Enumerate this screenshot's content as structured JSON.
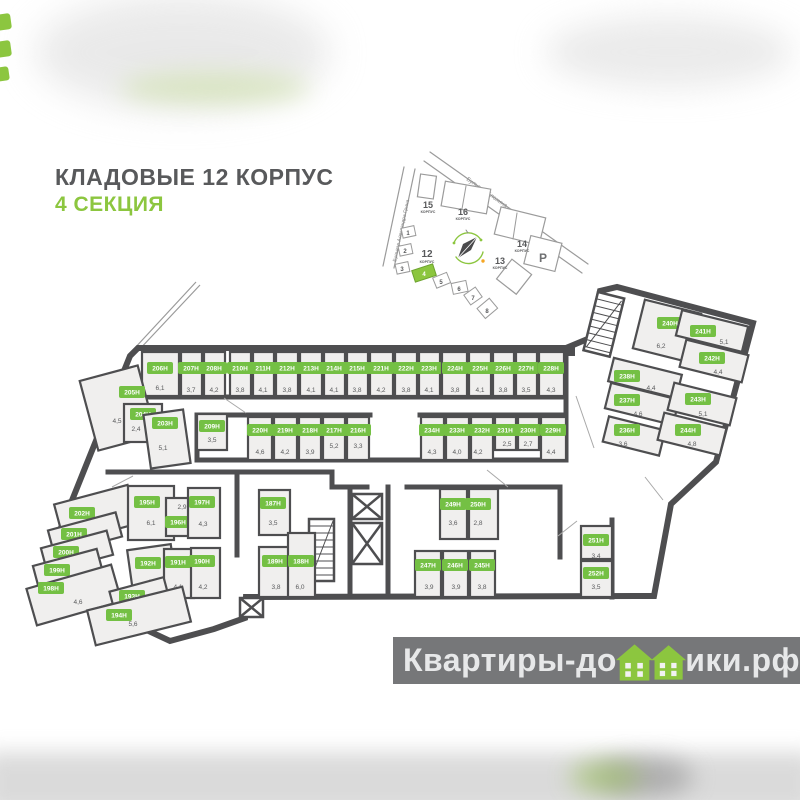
{
  "title": {
    "line1": "КЛАДОВЫЕ 12 КОРПУС",
    "line2": "4 СЕКЦИЯ"
  },
  "colors": {
    "accent_green": "#8cc63f",
    "chip_green": "#74c044",
    "wall": "#4e4e50",
    "room_fill": "#f0efee",
    "text_gray": "#58595b",
    "watermark_bar": "#6c6d6f"
  },
  "watermark": {
    "before": "Квартиры-до",
    "after": "ики.рф"
  },
  "sitemap": {
    "streets": [
      "Бульвар Блохина",
      "Бульвар Александра Грина"
    ],
    "korpus_label": "КОРПУС",
    "buildings": [
      {
        "num": "15"
      },
      {
        "num": "16"
      },
      {
        "num": "14"
      },
      {
        "num": "13"
      },
      {
        "num": "12"
      }
    ],
    "parking": "Р",
    "sections": [
      "1",
      "2",
      "3",
      "4",
      "5",
      "6",
      "7",
      "8"
    ],
    "active_section": "4"
  },
  "legend": {
    "unit_suffix": "Н"
  },
  "rooms": [
    {
      "l": "206Н",
      "a": "6,1",
      "r": [
        142,
        352,
        37,
        44,
        0
      ],
      "c": [
        160,
        368
      ],
      "t": [
        160,
        388
      ]
    },
    {
      "l": "207Н",
      "a": "3,7",
      "r": [
        181,
        352,
        21,
        44,
        0
      ],
      "c": [
        191,
        368
      ],
      "t": [
        191,
        390
      ]
    },
    {
      "l": "208Н",
      "a": "4,2",
      "r": [
        204,
        352,
        21,
        44,
        0
      ],
      "c": [
        214,
        368
      ],
      "t": [
        214,
        390
      ]
    },
    {
      "l": "210Н",
      "a": "3,8",
      "r": [
        230,
        352,
        21,
        44,
        0
      ],
      "c": [
        240,
        368
      ],
      "t": [
        240,
        390
      ]
    },
    {
      "l": "211Н",
      "a": "4,1",
      "r": [
        253,
        352,
        21,
        44,
        0
      ],
      "c": [
        263,
        368
      ],
      "t": [
        263,
        390
      ]
    },
    {
      "l": "212Н",
      "a": "3,8",
      "r": [
        276,
        352,
        22,
        44,
        0
      ],
      "c": [
        287,
        368
      ],
      "t": [
        287,
        390
      ]
    },
    {
      "l": "213Н",
      "a": "4,1",
      "r": [
        300,
        352,
        22,
        44,
        0
      ],
      "c": [
        311,
        368
      ],
      "t": [
        311,
        390
      ]
    },
    {
      "l": "214Н",
      "a": "4,1",
      "r": [
        324,
        352,
        21,
        44,
        0
      ],
      "c": [
        334,
        368
      ],
      "t": [
        334,
        390
      ]
    },
    {
      "l": "215Н",
      "a": "3,8",
      "r": [
        347,
        352,
        21,
        44,
        0
      ],
      "c": [
        357,
        368
      ],
      "t": [
        357,
        390
      ]
    },
    {
      "l": "221Н",
      "a": "4,2",
      "r": [
        370,
        352,
        23,
        44,
        0
      ],
      "c": [
        381,
        368
      ],
      "t": [
        381,
        390
      ]
    },
    {
      "l": "222Н",
      "a": "3,8",
      "r": [
        395,
        352,
        22,
        44,
        0
      ],
      "c": [
        406,
        368
      ],
      "t": [
        406,
        390
      ]
    },
    {
      "l": "223Н",
      "a": "4,1",
      "r": [
        419,
        352,
        21,
        44,
        0
      ],
      "c": [
        429,
        368
      ],
      "t": [
        429,
        390
      ]
    },
    {
      "l": "224Н",
      "a": "3,8",
      "r": [
        442,
        352,
        25,
        44,
        0
      ],
      "c": [
        455,
        368
      ],
      "t": [
        455,
        390
      ]
    },
    {
      "l": "225Н",
      "a": "4,1",
      "r": [
        469,
        352,
        22,
        44,
        0
      ],
      "c": [
        480,
        368
      ],
      "t": [
        480,
        390
      ]
    },
    {
      "l": "226Н",
      "a": "3,8",
      "r": [
        493,
        352,
        21,
        44,
        0
      ],
      "c": [
        503,
        368
      ],
      "t": [
        503,
        390
      ]
    },
    {
      "l": "227Н",
      "a": "3,5",
      "r": [
        516,
        352,
        21,
        44,
        0
      ],
      "c": [
        526,
        368
      ],
      "t": [
        526,
        390
      ]
    },
    {
      "l": "228Н",
      "a": "4,3",
      "r": [
        539,
        352,
        25,
        44,
        0
      ],
      "c": [
        551,
        368
      ],
      "t": [
        551,
        390
      ]
    },
    {
      "l": "209Н",
      "a": "3,5",
      "r": [
        197,
        414,
        30,
        36,
        0
      ],
      "c": [
        212,
        426
      ],
      "t": [
        212,
        440
      ]
    },
    {
      "l": "220Н",
      "a": "4,6",
      "r": [
        248,
        417,
        24,
        43,
        0
      ],
      "c": [
        260,
        430
      ],
      "t": [
        260,
        452
      ]
    },
    {
      "l": "219Н",
      "a": "4,2",
      "r": [
        274,
        417,
        23,
        43,
        0
      ],
      "c": [
        285,
        430
      ],
      "t": [
        285,
        452
      ]
    },
    {
      "l": "218Н",
      "a": "3,9",
      "r": [
        299,
        417,
        22,
        43,
        0
      ],
      "c": [
        310,
        430
      ],
      "t": [
        310,
        452
      ]
    },
    {
      "l": "217Н",
      "a": "5,2",
      "r": [
        323,
        417,
        22,
        43,
        0
      ],
      "c": [
        334,
        430
      ],
      "t": [
        334,
        446
      ]
    },
    {
      "l": "216Н",
      "a": "3,3",
      "r": [
        347,
        417,
        22,
        43,
        0
      ],
      "c": [
        358,
        430
      ],
      "t": [
        358,
        446
      ]
    },
    {
      "l": "234Н",
      "a": "4,3",
      "r": [
        421,
        417,
        23,
        43,
        0
      ],
      "c": [
        432,
        430
      ],
      "t": [
        432,
        452
      ]
    },
    {
      "l": "233Н",
      "a": "4,0",
      "r": [
        446,
        417,
        23,
        43,
        0
      ],
      "c": [
        457,
        430
      ],
      "t": [
        457,
        452
      ]
    },
    {
      "l": "232Н",
      "a": "4,2",
      "r": [
        471,
        417,
        22,
        43,
        0
      ],
      "c": [
        482,
        430
      ],
      "t": [
        478,
        452
      ]
    },
    {
      "l": "231Н",
      "a": "2,5",
      "r": [
        495,
        417,
        21,
        33,
        0
      ],
      "c": [
        505,
        430
      ],
      "t": [
        507,
        444
      ]
    },
    {
      "l": "230Н",
      "a": "2,7",
      "r": [
        518,
        417,
        21,
        33,
        0
      ],
      "c": [
        528,
        430
      ],
      "t": [
        528,
        444
      ]
    },
    {
      "l": "229Н",
      "a": "4,4",
      "r": [
        541,
        417,
        25,
        43,
        0
      ],
      "c": [
        553,
        430
      ],
      "t": [
        551,
        452
      ]
    },
    {
      "l": "205Н",
      "a": "4,5",
      "r": [
        88,
        372,
        60,
        72,
        -15
      ],
      "c": [
        132,
        392
      ],
      "t": [
        117,
        421
      ]
    },
    {
      "l": "204Н",
      "a": "2,4",
      "r": [
        124,
        404,
        38,
        38,
        0
      ],
      "c": [
        143,
        414
      ],
      "t": [
        136,
        429
      ]
    },
    {
      "l": "203Н",
      "a": "5,1",
      "r": [
        147,
        412,
        40,
        54,
        -8
      ],
      "c": [
        165,
        423
      ],
      "t": [
        163,
        448
      ]
    },
    {
      "l": "202Н",
      "a": "5,7",
      "r": [
        58,
        494,
        76,
        40,
        -15
      ],
      "c": [
        82,
        513
      ],
      "t": [
        96,
        520
      ]
    },
    {
      "l": "201Н",
      "a": "3,2",
      "r": [
        50,
        521,
        70,
        25,
        -15
      ],
      "c": [
        74,
        534
      ],
      "t": [
        87,
        541
      ]
    },
    {
      "l": "200Н",
      "a": "2,8",
      "r": [
        43,
        539,
        68,
        25,
        -15
      ],
      "c": [
        66,
        552
      ],
      "t": [
        78,
        559
      ]
    },
    {
      "l": "199Н",
      "a": "2,9",
      "r": [
        35,
        557,
        66,
        25,
        -15
      ],
      "c": [
        57,
        570
      ],
      "t": [
        72,
        578
      ]
    },
    {
      "l": "198Н",
      "a": "4,6",
      "r": [
        30,
        576,
        88,
        38,
        -16
      ],
      "c": [
        51,
        588
      ],
      "t": [
        78,
        602
      ]
    },
    {
      "l": "195Н",
      "a": "6,1",
      "r": [
        128,
        486,
        46,
        54,
        0
      ],
      "c": [
        147,
        502
      ],
      "t": [
        151,
        523
      ]
    },
    {
      "l": "196Н",
      "a": "2,9",
      "r": [
        166,
        498,
        29,
        38,
        0
      ],
      "c": [
        178,
        522
      ],
      "t": [
        182,
        507
      ]
    },
    {
      "l": "197Н",
      "a": "4,3",
      "r": [
        188,
        488,
        32,
        50,
        0
      ],
      "c": [
        202,
        502
      ],
      "t": [
        203,
        524
      ]
    },
    {
      "l": "192Н",
      "a": "4,5",
      "r": [
        130,
        547,
        44,
        44,
        -8
      ],
      "c": [
        148,
        563
      ],
      "t": [
        152,
        582
      ]
    },
    {
      "l": "191Н",
      "a": "4,1",
      "r": [
        164,
        549,
        30,
        49,
        0
      ],
      "c": [
        178,
        562
      ],
      "t": [
        178,
        587
      ]
    },
    {
      "l": "190Н",
      "a": "4,2",
      "r": [
        191,
        548,
        29,
        50,
        0
      ],
      "c": [
        202,
        561
      ],
      "t": [
        203,
        587
      ]
    },
    {
      "l": "193Н",
      "a": "3,4",
      "r": [
        112,
        584,
        56,
        27,
        -15
      ],
      "c": [
        132,
        596
      ],
      "t": [
        146,
        603
      ]
    },
    {
      "l": "194Н",
      "a": "5,6",
      "r": [
        90,
        598,
        98,
        36,
        -14
      ],
      "c": [
        119,
        615
      ],
      "t": [
        133,
        624
      ]
    },
    {
      "l": "187Н",
      "a": "3,5",
      "r": [
        259,
        490,
        31,
        45,
        0
      ],
      "c": [
        273,
        503
      ],
      "t": [
        273,
        523
      ]
    },
    {
      "l": "189Н",
      "a": "3,8",
      "r": [
        259,
        547,
        31,
        50,
        0
      ],
      "c": [
        275,
        561
      ],
      "t": [
        276,
        587
      ]
    },
    {
      "l": "188Н",
      "a": "6,0",
      "r": [
        288,
        533,
        27,
        64,
        0
      ],
      "c": [
        301,
        561
      ],
      "t": [
        300,
        587
      ]
    },
    {
      "l": "249Н",
      "a": "3,6",
      "r": [
        440,
        489,
        27,
        50,
        0
      ],
      "c": [
        453,
        504
      ],
      "t": [
        453,
        523
      ]
    },
    {
      "l": "250Н",
      "a": "2,8",
      "r": [
        469,
        489,
        29,
        50,
        0
      ],
      "c": [
        478,
        504
      ],
      "t": [
        478,
        523
      ]
    },
    {
      "l": "247Н",
      "a": "3,9",
      "r": [
        415,
        551,
        26,
        46,
        0
      ],
      "c": [
        428,
        565
      ],
      "t": [
        429,
        587
      ]
    },
    {
      "l": "246Н",
      "a": "3,9",
      "r": [
        443,
        551,
        25,
        46,
        0
      ],
      "c": [
        455,
        565
      ],
      "t": [
        456,
        587
      ]
    },
    {
      "l": "245Н",
      "a": "3,8",
      "r": [
        470,
        551,
        25,
        46,
        0
      ],
      "c": [
        482,
        565
      ],
      "t": [
        482,
        587
      ]
    },
    {
      "l": "251Н",
      "a": "3,4",
      "r": [
        581,
        526,
        31,
        33,
        0
      ],
      "c": [
        596,
        540
      ],
      "t": [
        596,
        556
      ]
    },
    {
      "l": "252Н",
      "a": "3,5",
      "r": [
        581,
        561,
        31,
        36,
        0
      ],
      "c": [
        596,
        573
      ],
      "t": [
        596,
        587
      ]
    },
    {
      "l": "240Н",
      "a": "6,2",
      "r": [
        638,
        306,
        58,
        50,
        14
      ],
      "c": [
        670,
        323
      ],
      "t": [
        661,
        346
      ]
    },
    {
      "l": "241Н",
      "a": "5,1",
      "r": [
        678,
        318,
        68,
        26,
        14
      ],
      "c": [
        703,
        331
      ],
      "t": [
        724,
        342
      ]
    },
    {
      "l": "242Н",
      "a": "4,4",
      "r": [
        682,
        347,
        64,
        28,
        14
      ],
      "c": [
        712,
        358
      ],
      "t": [
        718,
        372
      ]
    },
    {
      "l": "238Н",
      "a": "4,4",
      "r": [
        610,
        366,
        70,
        24,
        14
      ],
      "c": [
        627,
        376
      ],
      "t": [
        651,
        388
      ]
    },
    {
      "l": "237Н",
      "a": "4,6",
      "r": [
        607,
        391,
        70,
        26,
        14
      ],
      "c": [
        627,
        400
      ],
      "t": [
        638,
        414
      ]
    },
    {
      "l": "236Н",
      "a": "3,6",
      "r": [
        605,
        423,
        58,
        26,
        14
      ],
      "c": [
        627,
        430
      ],
      "t": [
        623,
        444
      ]
    },
    {
      "l": "243Н",
      "a": "5,1",
      "r": [
        670,
        390,
        64,
        28,
        14
      ],
      "c": [
        698,
        399
      ],
      "t": [
        703,
        414
      ]
    },
    {
      "l": "244Н",
      "a": "4,8",
      "r": [
        660,
        420,
        64,
        28,
        14
      ],
      "c": [
        688,
        430
      ],
      "t": [
        692,
        444
      ]
    }
  ]
}
